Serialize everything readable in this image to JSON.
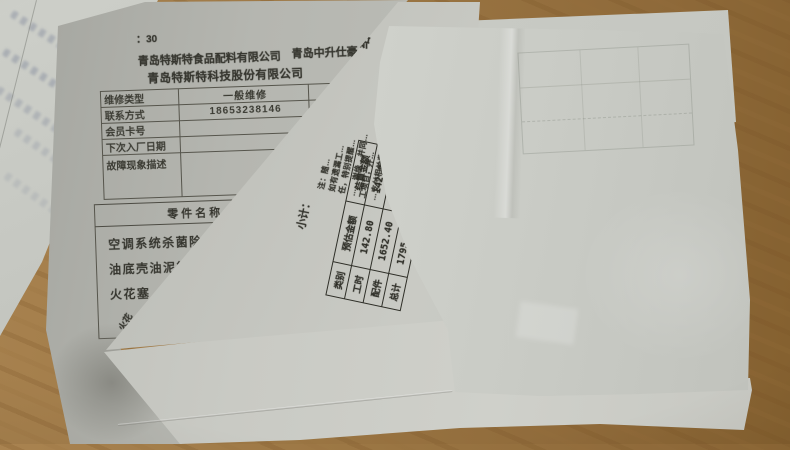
{
  "scene": {
    "desk_color": "#9c7744",
    "paper_color": "#c3c4be",
    "description_colors": {
      "form_ink": "#35352e",
      "table_ink": "#2e2e27"
    }
  },
  "repair_form": {
    "time_fragment": "：30",
    "supplier_line": "青岛特斯特食品配料有限公司",
    "dealer_line": "青岛中升仕豪",
    "company_line": "青岛特斯特科技股份有限公司",
    "info_rows": [
      {
        "label": "维修类型",
        "value": "一般维修"
      },
      {
        "label": "联系方式",
        "value": "18653238146"
      },
      {
        "label": "会员卡号",
        "value": ""
      },
      {
        "label": "下次入厂日期",
        "value": ""
      },
      {
        "label": "故障现象描述",
        "value": ""
      }
    ],
    "parts_header": "零件名称",
    "parts_items": [
      "空调系统杀菌除臭剂",
      "油底壳油泥彻底清洗",
      "火花塞"
    ],
    "fold_fragment": "火花"
  },
  "settlement_sheet": {
    "title_fragment": "结",
    "subtotal_label": "小计：",
    "note_lines": [
      "注：随…",
      "如有遗漏工…",
      "任，特别提醒…",
      "…，谢绝…并同…",
      "工项目，并…",
      "…支付相关费用。"
    ],
    "totals": {
      "headers": [
        "类别",
        "预估金额",
        "结算金额"
      ],
      "rows": [
        {
          "label": "工时",
          "estimate": "142.80",
          "settle": "142.80"
        },
        {
          "label": "配件",
          "estimate": "1652.40",
          "settle": "1652.40"
        },
        {
          "label": "总计",
          "estimate": "1795.20",
          "settle": "1795.20"
        }
      ]
    }
  }
}
